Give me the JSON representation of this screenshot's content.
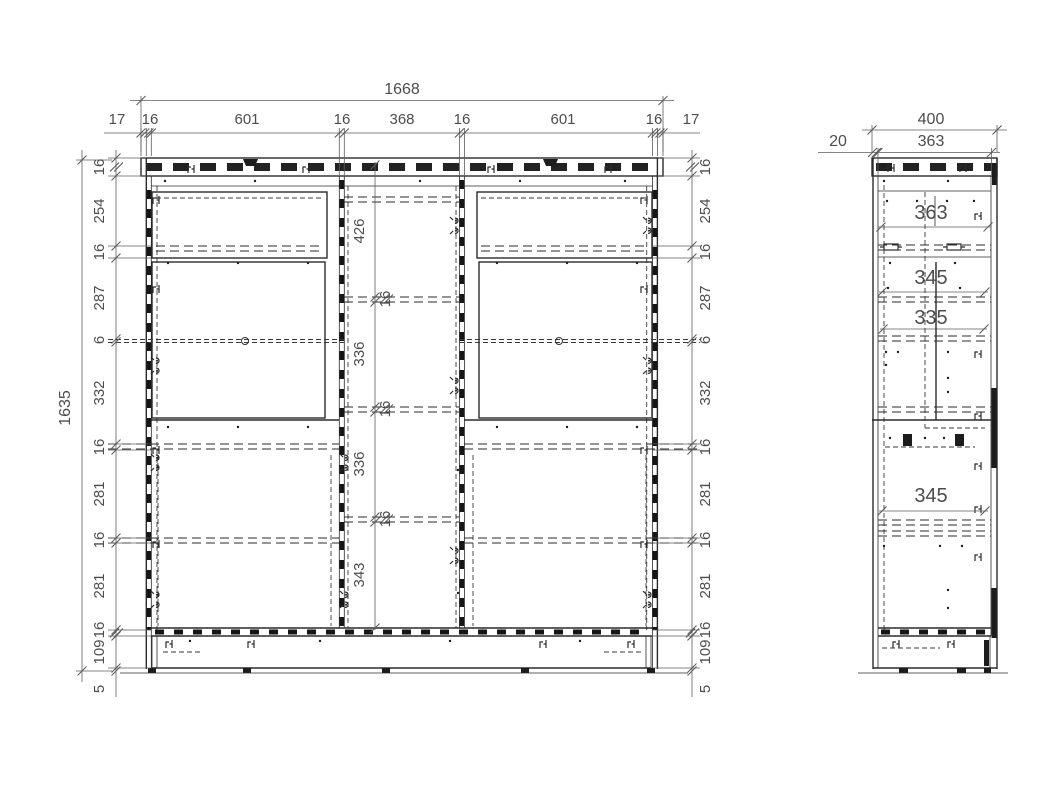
{
  "drawing_type": "cabinet-assembly-dimension-drawing",
  "colors": {
    "background": "#ffffff",
    "line": "#2b2b2b",
    "dim_text": "#4d4d4d"
  },
  "front_view": {
    "overall_width": "1668",
    "overall_height": "1635",
    "top_chain": [
      "17",
      "16",
      "601",
      "16",
      "368",
      "16",
      "601",
      "16",
      "17"
    ],
    "left_chain": [
      "16",
      "254",
      "16",
      "287",
      "6",
      "332",
      "16",
      "281",
      "16",
      "281",
      "16",
      "109"
    ],
    "left_chain_bottom": "5",
    "right_chain": [
      "16",
      "254",
      "16",
      "287",
      "6",
      "332",
      "16",
      "281",
      "16",
      "281",
      "16",
      "109"
    ],
    "right_chain_bottom": "5",
    "center_chain": [
      "426",
      "16",
      "336",
      "16",
      "336",
      "16",
      "343"
    ]
  },
  "side_view": {
    "overall_depth": "400",
    "inner_depth": "363",
    "front_offset": "20",
    "compartment_dims": [
      "363",
      "345",
      "335",
      "345"
    ]
  }
}
